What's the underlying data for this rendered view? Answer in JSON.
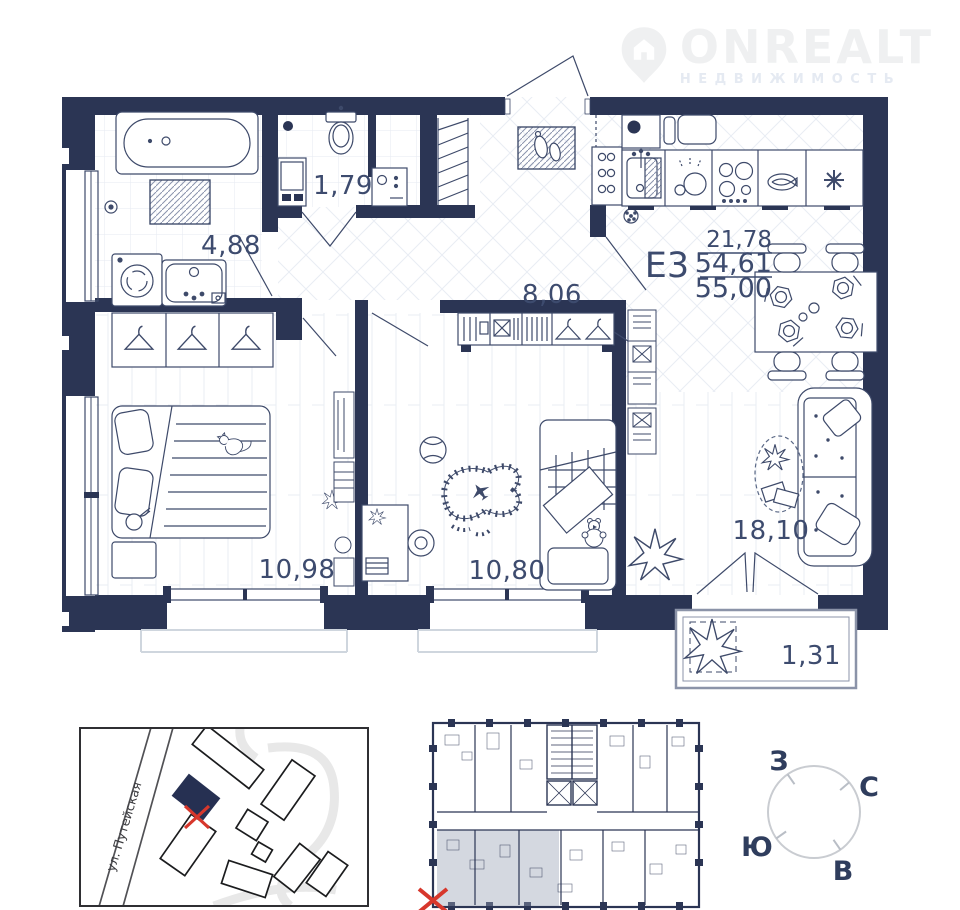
{
  "watermark": {
    "brand": "ONREALT",
    "tagline": "НЕДВИЖИМОСТЬ"
  },
  "unit": {
    "code": "Е3",
    "area_living": "21,78",
    "area_without_balcony": "54,61",
    "area_total": "55,00"
  },
  "rooms": {
    "bathroom": "4,88",
    "wc": "1,79",
    "hall": "8,06",
    "bedroom": "10,98",
    "kids": "10,80",
    "living": "18,10",
    "balcony": "1,31"
  },
  "map": {
    "street": "ул. Путейская"
  },
  "compass": {
    "west": "З",
    "north": "С",
    "south": "Ю",
    "east": "В"
  },
  "colors": {
    "wall": "#2b3554",
    "label": "#3d4b6e",
    "marker_red": "#d7372c"
  }
}
